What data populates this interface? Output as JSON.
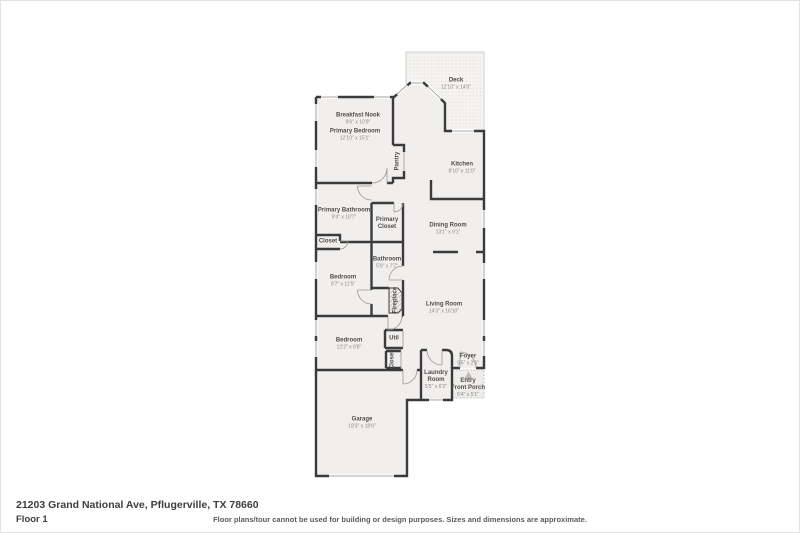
{
  "meta": {
    "address": "21203 Grand National Ave, Pflugerville, TX 78660",
    "floor_label": "Floor 1",
    "disclaimer": "Floor plans/tour cannot be used for building or design purposes. Sizes and dimensions are approximate."
  },
  "colors": {
    "wall": "#3b3b3b",
    "floor": "#f0efee",
    "deck_dot": "#dbd9d6",
    "label_text": "#4f4d4a",
    "dims_text": "#8a8885"
  },
  "rooms": [
    {
      "id": "deck",
      "name": "Deck",
      "dims": "12'10\" x 14'0\""
    },
    {
      "id": "breakfast-nook",
      "name": "Breakfast Nook",
      "dims": "9'6\" x 10'9\""
    },
    {
      "id": "primary-bedroom",
      "name": "Primary Bedroom",
      "dims": "12'10\" x 15'1\""
    },
    {
      "id": "kitchen",
      "name": "Kitchen",
      "dims": "8'10\" x 11'0\""
    },
    {
      "id": "primary-bathroom",
      "name": "Primary Bathroom",
      "dims": "9'4\" x 10'7\""
    },
    {
      "id": "primary-closet",
      "name": "Primary\nCloset",
      "dims": ""
    },
    {
      "id": "dining-room",
      "name": "Dining Room",
      "dims": "13'1\" x 9'1\""
    },
    {
      "id": "closet",
      "name": "Closet",
      "dims": ""
    },
    {
      "id": "bathroom",
      "name": "Bathroom",
      "dims": "5'0\" x 7'7\""
    },
    {
      "id": "bedroom-2",
      "name": "Bedroom",
      "dims": "9'7\" x 11'5\""
    },
    {
      "id": "living-room",
      "name": "Living Room",
      "dims": "14'3\" x 16'10\""
    },
    {
      "id": "bedroom-3",
      "name": "Bedroom",
      "dims": "12'2\" x 9'8\""
    },
    {
      "id": "util",
      "name": "Util",
      "dims": ""
    },
    {
      "id": "laundry-room",
      "name": "Laundry\nRoom",
      "dims": "5'5\" x 6'2\""
    },
    {
      "id": "foyer",
      "name": "Foyer",
      "dims": "5'5\" x 2'6\""
    },
    {
      "id": "entry-front-porch",
      "name": "Entry\nFront Porch",
      "dims": "5'4\" x 5'1\""
    },
    {
      "id": "garage",
      "name": "Garage",
      "dims": "18'3\" x 18'6\""
    },
    {
      "id": "pantry",
      "name": "Pantry",
      "dims": ""
    },
    {
      "id": "closet-vertical",
      "name": "Closet",
      "dims": ""
    },
    {
      "id": "fireplace",
      "name": "Fireplace",
      "dims": ""
    }
  ]
}
